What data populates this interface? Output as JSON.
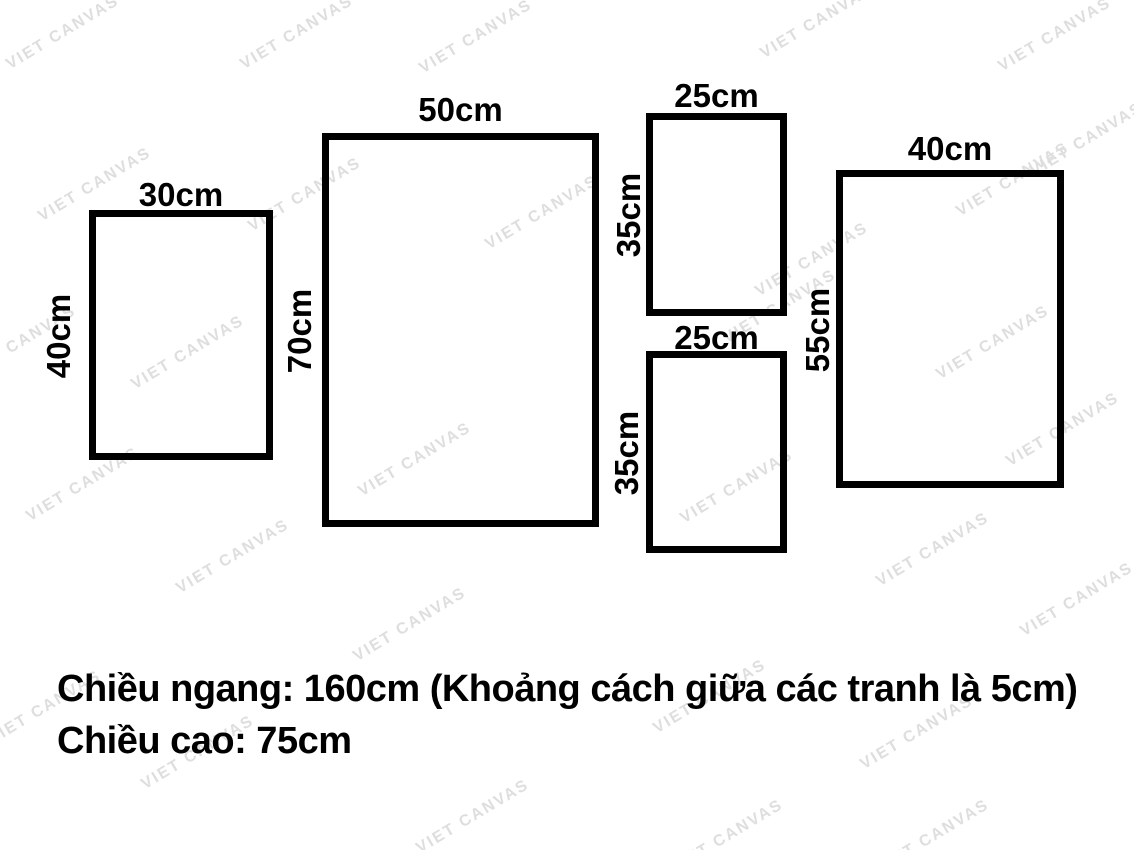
{
  "watermark": {
    "text": "VIET CANVAS",
    "color": "#dedede"
  },
  "frames": [
    {
      "name": "frame-30x40",
      "width_label": "30cm",
      "height_label": "40cm"
    },
    {
      "name": "frame-50x70",
      "width_label": "50cm",
      "height_label": "70cm"
    },
    {
      "name": "frame-25x35-top",
      "width_label": "25cm",
      "height_label": "35cm"
    },
    {
      "name": "frame-25x35-bottom",
      "width_label": "25cm",
      "height_label": "35cm"
    },
    {
      "name": "frame-40x55",
      "width_label": "40cm",
      "height_label": "55cm"
    }
  ],
  "caption": {
    "line1": "Chiều ngang: 160cm (Khoảng cách giữa các tranh là 5cm)",
    "line2": "Chiều cao: 75cm"
  },
  "colors": {
    "background": "#ffffff",
    "frame_border": "#000000",
    "label_text": "#000000",
    "watermark": "#dedede"
  }
}
